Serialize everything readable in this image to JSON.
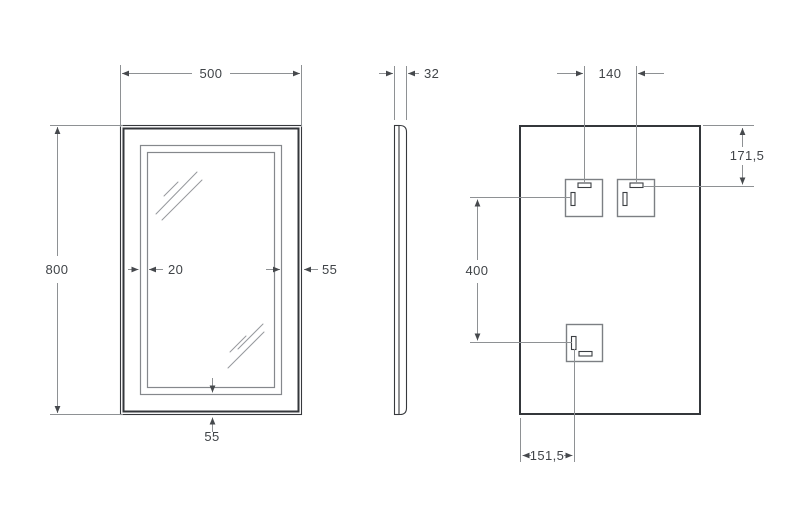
{
  "drawing": {
    "front_view": {
      "dim_width": "500",
      "dim_height": "800",
      "dim_inner_band": "20",
      "dim_side_inset": "55",
      "dim_bottom_inset": "55"
    },
    "side_view": {
      "dim_depth": "32"
    },
    "back_view": {
      "dim_bracket_spacing": "140",
      "dim_top_offset": "171,5",
      "dim_bracket_span": "400",
      "dim_left_offset": "151,5"
    },
    "colors": {
      "background": "#ffffff",
      "outline": "#34373b",
      "secondary_line": "#85888c",
      "dimension_line": "#8e9194",
      "text": "#404448"
    }
  }
}
